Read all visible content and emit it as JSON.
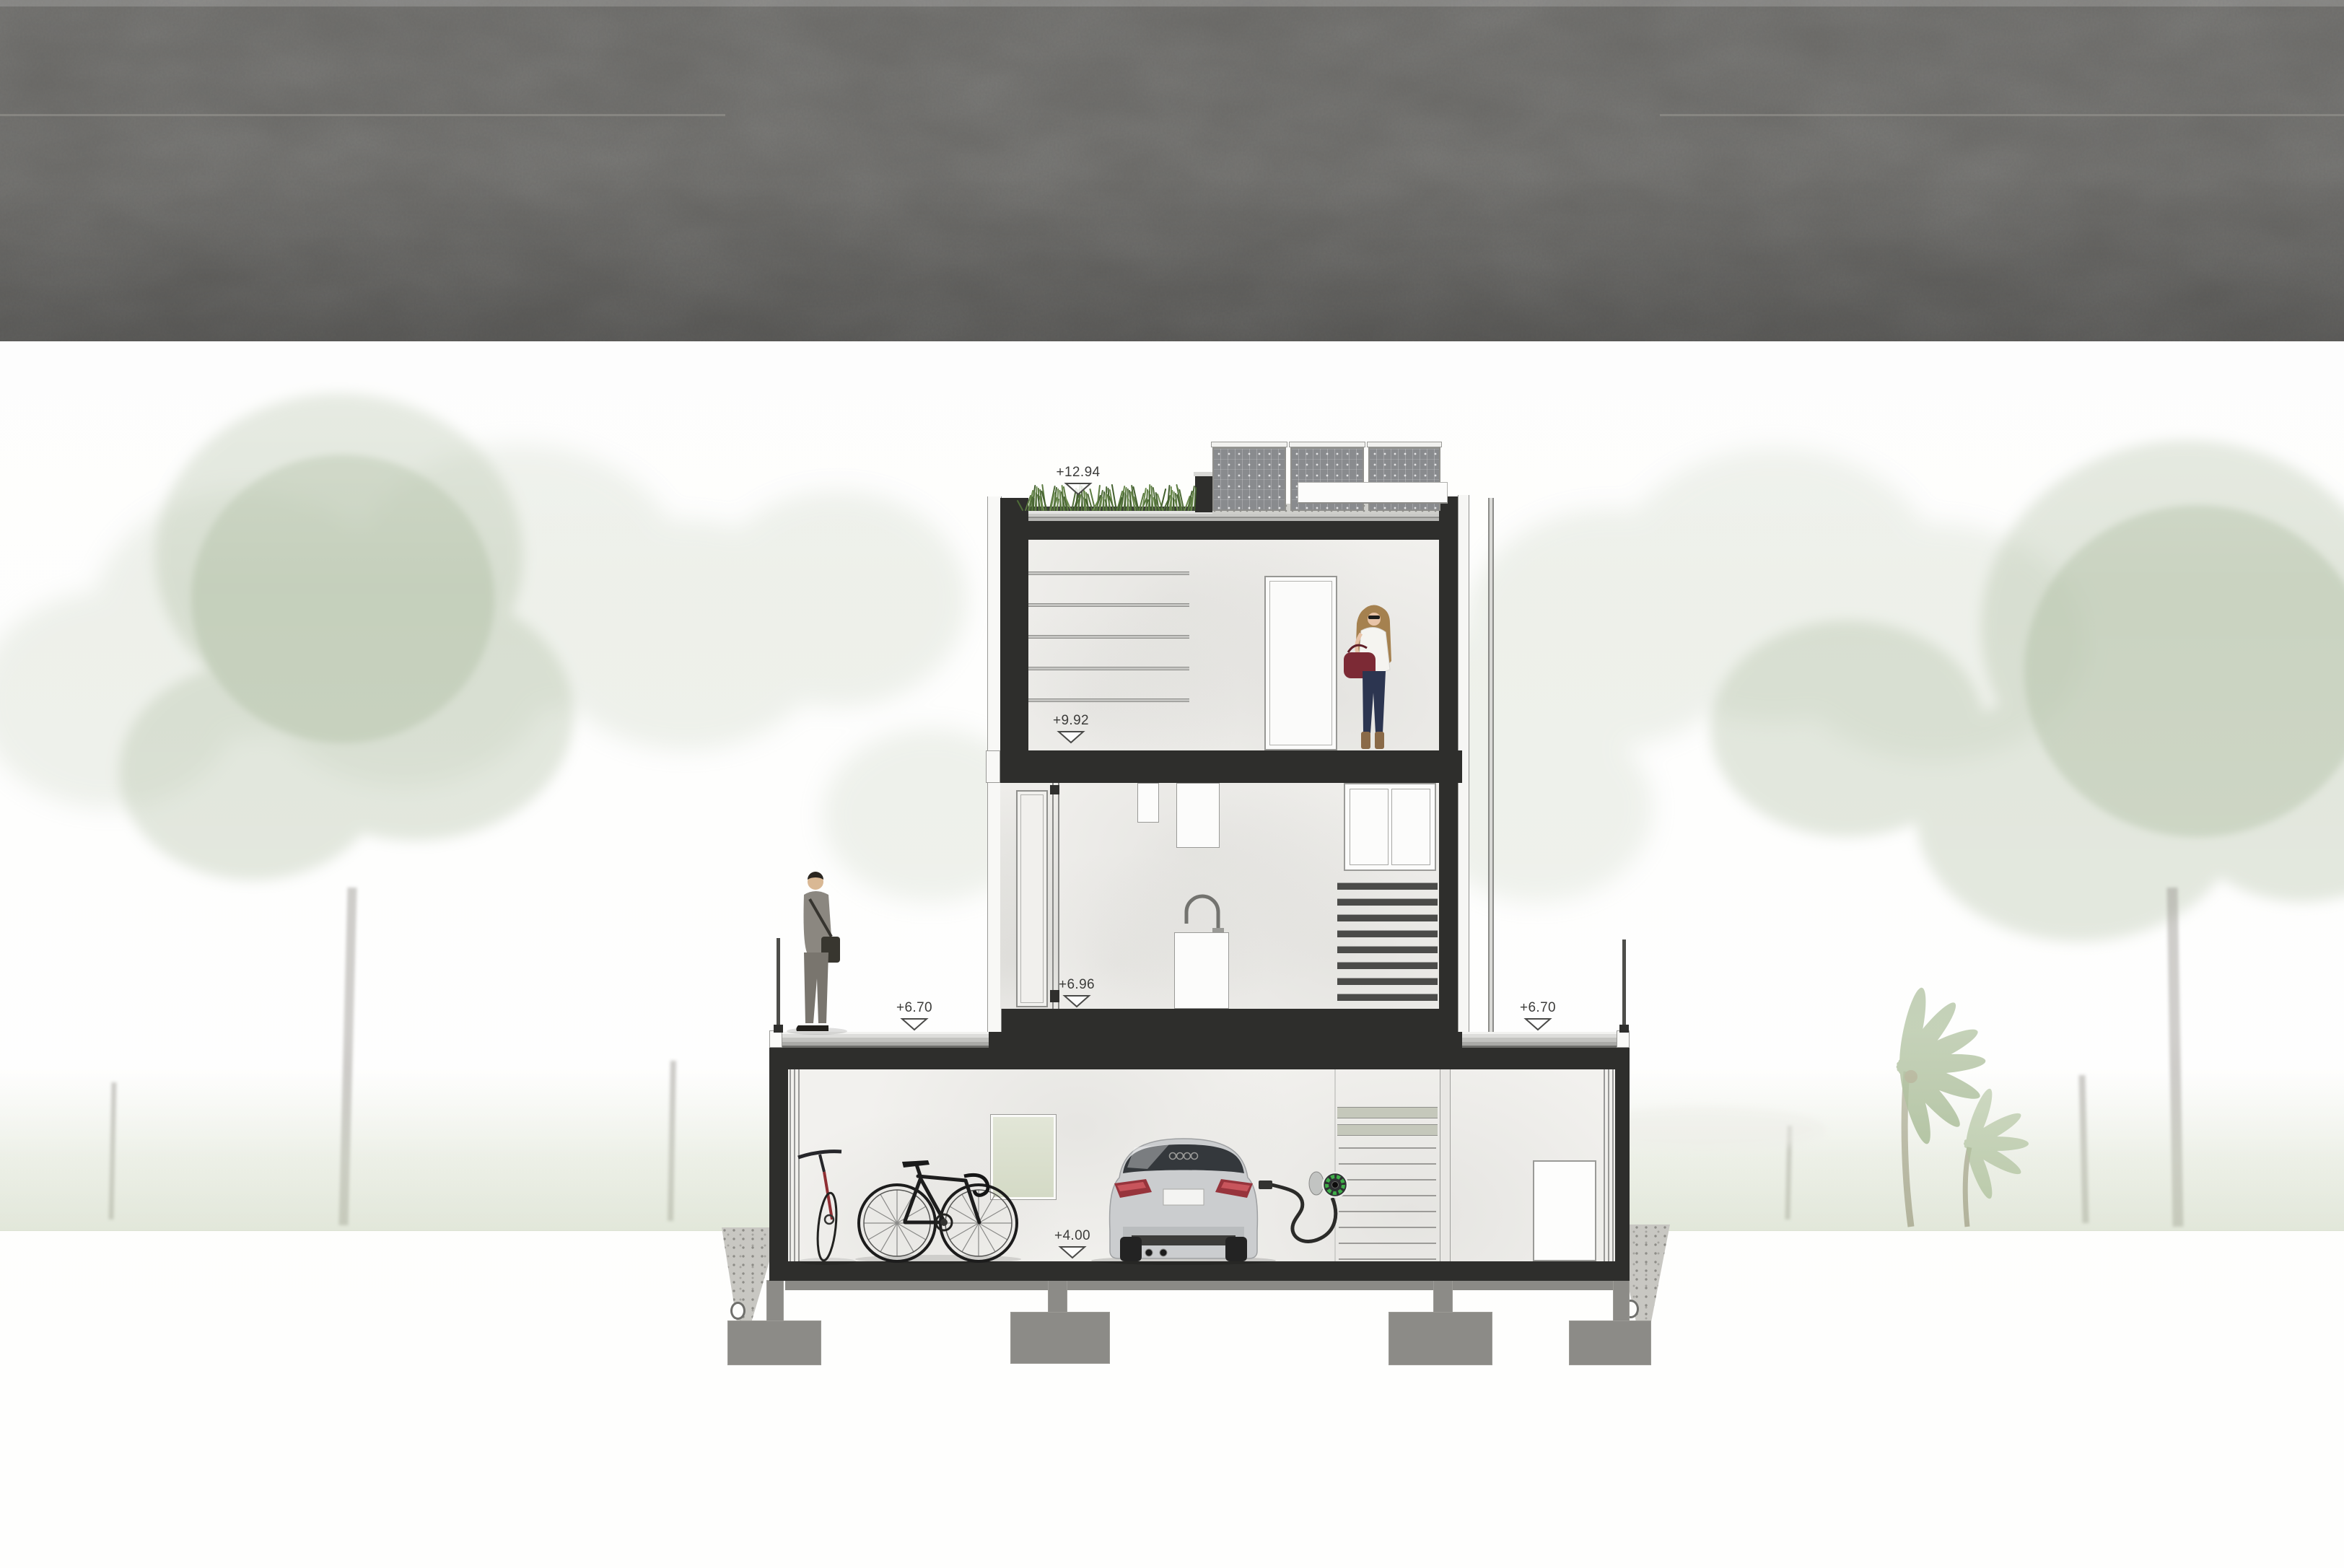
{
  "annotations": {
    "roof": "+12.94",
    "upper_floor": "+9.92",
    "main_floor": "+6.96",
    "terrace_left": "+6.70",
    "terrace_right": "+6.70",
    "garage_floor": "+4.00"
  },
  "palette": {
    "wall_dark": "#2e2e2c",
    "interior_plaster": "#f2f1ee",
    "roof_grass_green": "#5d7c42",
    "solar_panel_gray": "#898b8e",
    "charger_green": "#3fae49",
    "concrete_ground": "#6b6a67",
    "car_silver": "#cbcdcf",
    "taillight_red": "#97343c",
    "handbag_red": "#7c2a35",
    "tree_green_faded": "#9cae8c"
  }
}
